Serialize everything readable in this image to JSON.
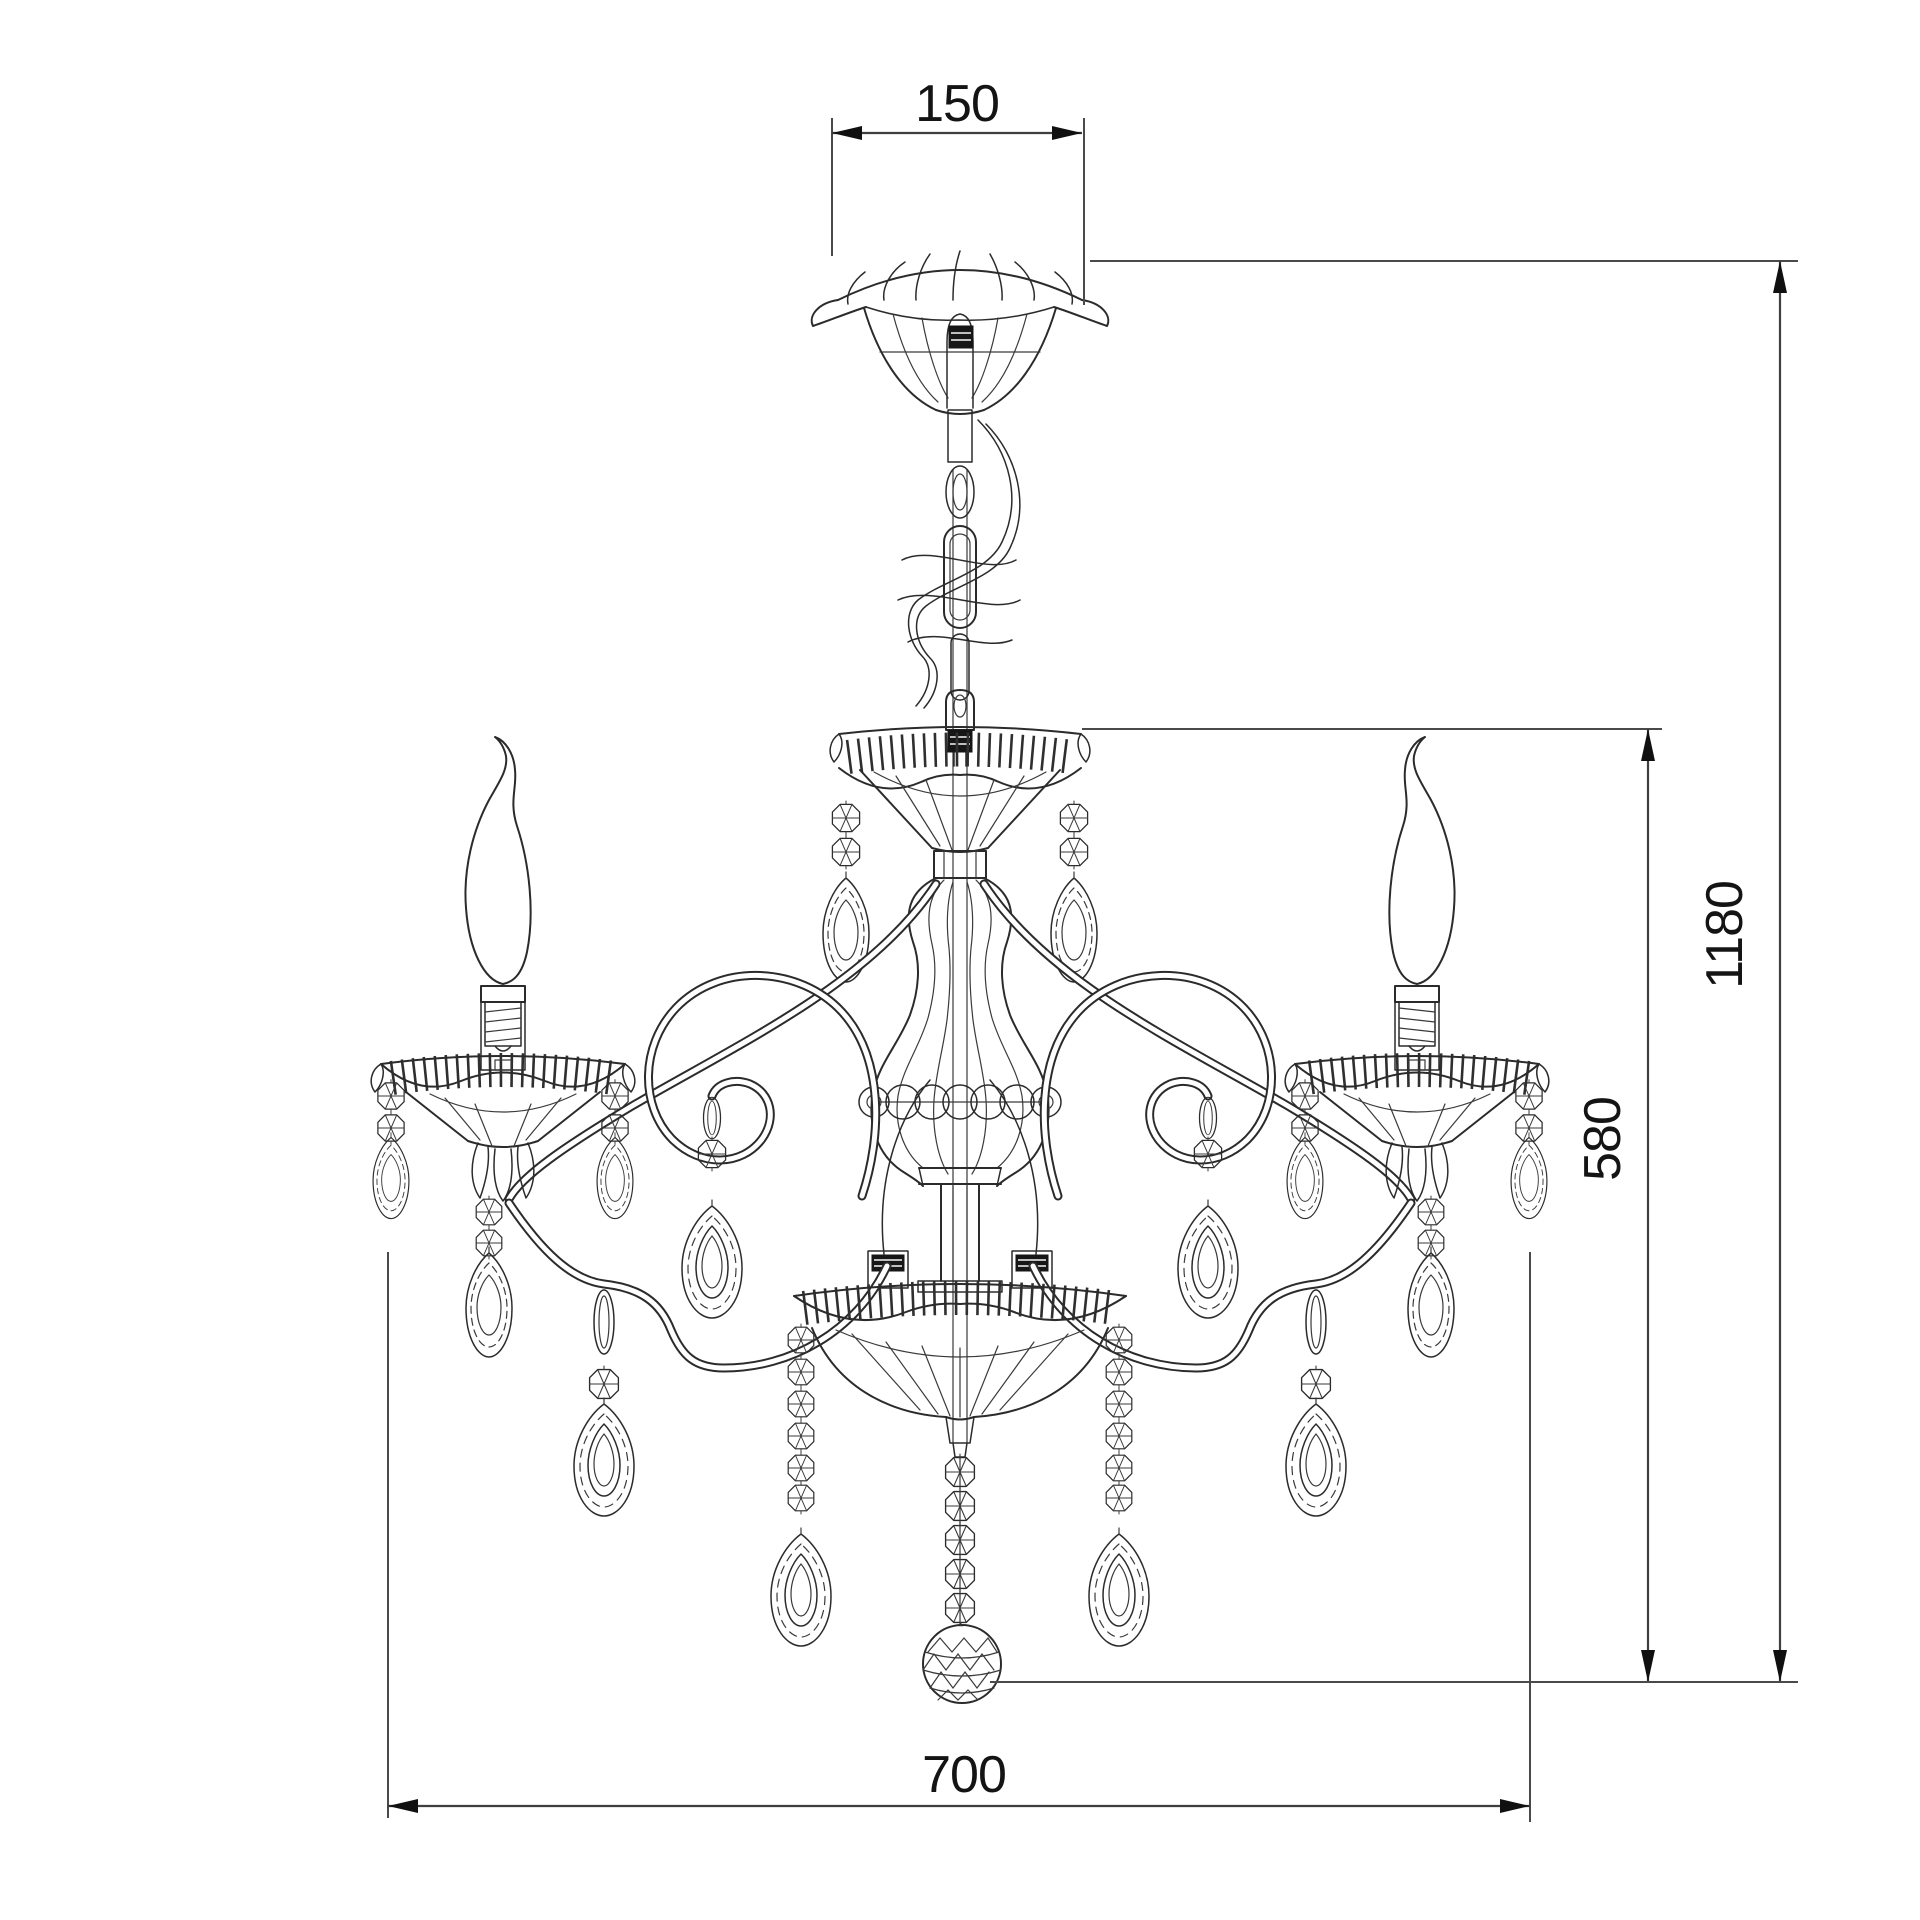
{
  "drawing": {
    "subject": "crystal chandelier dimensioned technical drawing",
    "style": "black line wireframe on white",
    "background": "#ffffff",
    "colors": {
      "line": "#2b2b2b",
      "dimension_line": "#3f3f3f",
      "text": "#141414",
      "hatch_fill": "#161616"
    },
    "dimensions": {
      "canopy_width": {
        "label": "150",
        "orientation": "horizontal",
        "position": "top"
      },
      "total_height": {
        "label": "1180",
        "orientation": "vertical",
        "position": "right-outer"
      },
      "body_height": {
        "label": "580",
        "orientation": "vertical",
        "position": "right-inner"
      },
      "body_width": {
        "label": "700",
        "orientation": "horizontal",
        "position": "bottom"
      }
    },
    "parts": [
      "ceiling-canopy",
      "suspension-chain",
      "power-cord",
      "upper-bobeche",
      "glass-baluster-column",
      "bead-ring",
      "left-scroll-arm",
      "right-scroll-arm",
      "candle-bulbs",
      "candle-bobeches",
      "crystal-octagon-beads",
      "crystal-teardrop-pendants",
      "bottom-bowl",
      "crystal-strands",
      "faceted-bottom-ball"
    ]
  }
}
